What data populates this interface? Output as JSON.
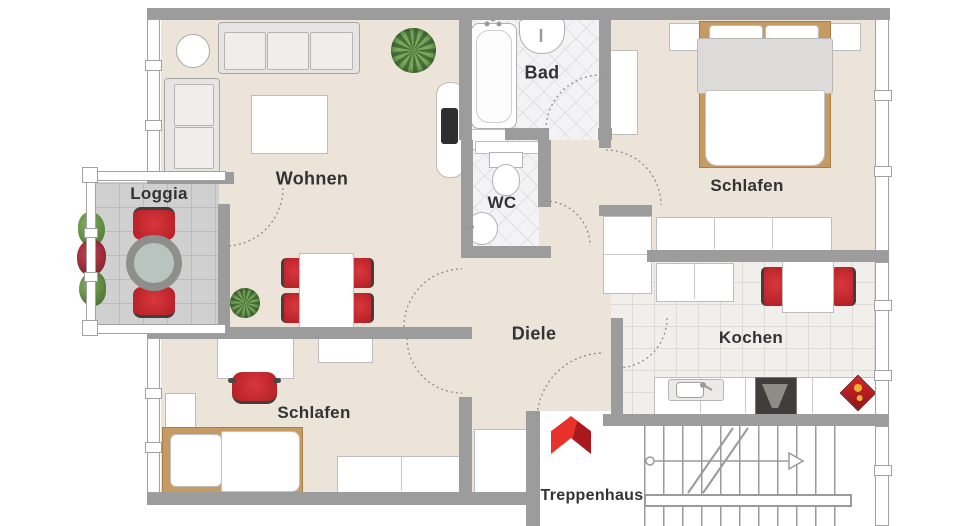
{
  "floorplan": {
    "rooms": [
      {
        "id": "wohnen",
        "label": "Wohnen"
      },
      {
        "id": "loggia",
        "label": "Loggia"
      },
      {
        "id": "bad",
        "label": "Bad"
      },
      {
        "id": "wc",
        "label": "WC"
      },
      {
        "id": "schlafen-top",
        "label": "Schlafen"
      },
      {
        "id": "schlafen-bottom",
        "label": "Schlafen"
      },
      {
        "id": "diele",
        "label": "Diele"
      },
      {
        "id": "kochen",
        "label": "Kochen"
      },
      {
        "id": "treppenhaus",
        "label": "Treppenhaus"
      }
    ],
    "colors": {
      "wall_gray": "#9c9c9c",
      "floor_beige": "#ece3d9",
      "chair_red": "#c5262c",
      "entry_arrow_red": "#e8312a",
      "bed_frame_tan": "#c59a63",
      "label_text": "#333333"
    }
  }
}
